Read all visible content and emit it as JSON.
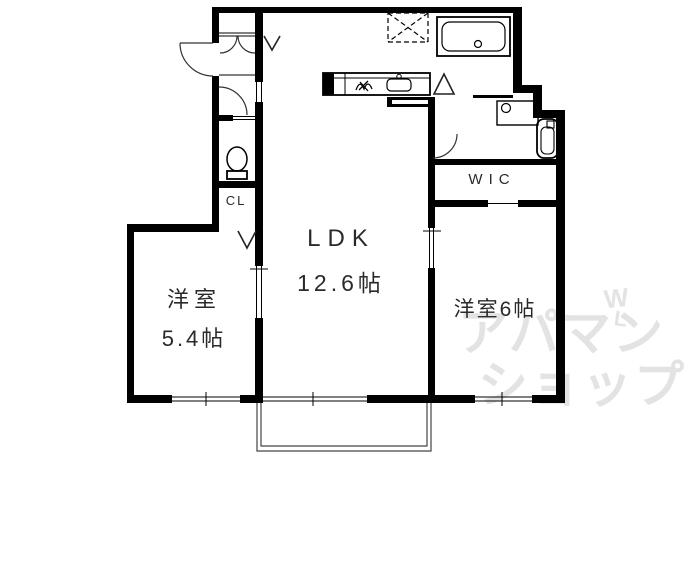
{
  "floorplan": {
    "rooms": {
      "ldk": {
        "name": "LDK",
        "size": "12.6帖"
      },
      "bedroom_left": {
        "name": "洋室",
        "size": "5.4帖"
      },
      "bedroom_right": {
        "name": "洋室6帖"
      },
      "wic": {
        "label": "WIC"
      },
      "closet": {
        "label": "CL"
      }
    },
    "watermark": {
      "line1": "アパマン",
      "line2": "ショップ",
      "mark_top": "W",
      "mark_bottom": "L"
    },
    "fixtures": [
      "bathtub",
      "toilet",
      "kitchen-counter",
      "kitchen-sink",
      "gas-stove",
      "washbasin",
      "water-heater",
      "washing-machine-space",
      "balcony",
      "entrance-door",
      "closet-double-doors"
    ],
    "colors": {
      "line": "#000000",
      "text": "#2a2a2a",
      "watermark": "#e3e3e3",
      "background": "#ffffff"
    }
  }
}
